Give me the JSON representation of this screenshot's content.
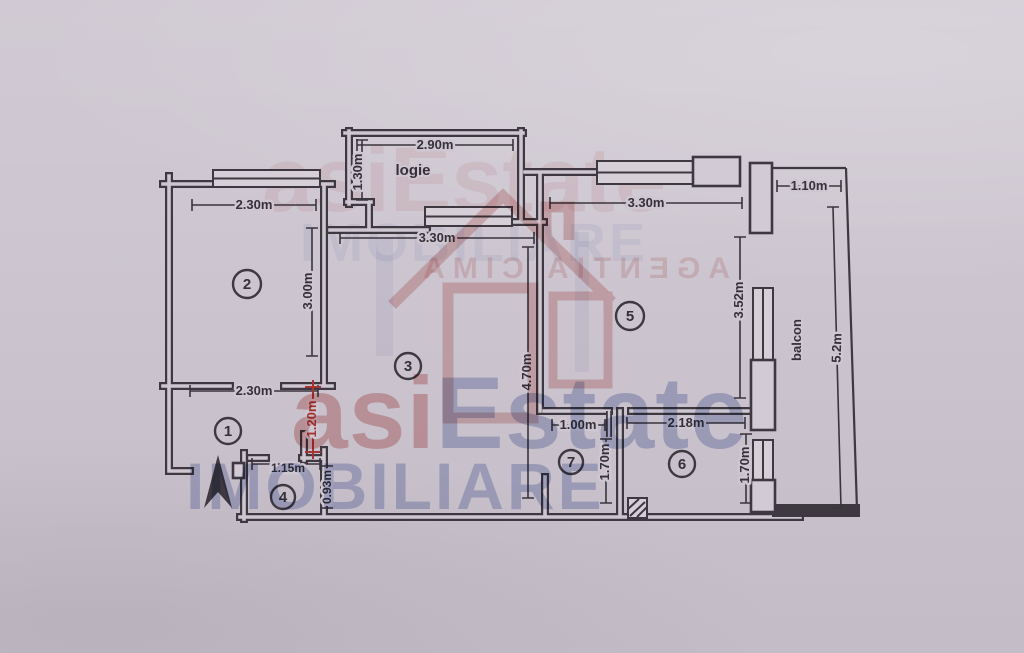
{
  "labels": {
    "loggia": "logie",
    "balcony": "balcon"
  },
  "rooms": [
    {
      "n": "1"
    },
    {
      "n": "2"
    },
    {
      "n": "3"
    },
    {
      "n": "4"
    },
    {
      "n": "5"
    },
    {
      "n": "6"
    },
    {
      "n": "7"
    }
  ],
  "dims": {
    "logie_width": "2.90m",
    "logie_depth": "1.30m",
    "room2_width": "2.30m",
    "room2_depth": "3.00m",
    "room1_width": "2.30m",
    "hall_opening": "1.20m",
    "room4_width": "1.15m",
    "room4_depth": "0.93m",
    "room3_width": "3.30m",
    "room3_depth": "4.70m",
    "room5_width": "3.30m",
    "room5_depth": "3.52m",
    "balcony_top_width": "1.10m",
    "balcony_length": "5.2m",
    "room7_width": "1.00m",
    "room7_depth": "1.70m",
    "room6_width": "2.18m",
    "room6_depth": "1.70m"
  },
  "watermark": {
    "brand_prefix": "asi",
    "brand_suffix": "Estate",
    "brand_line2": "IMOBILIARE",
    "faint_row": "asiEstate",
    "faint_row2": "IMOBILIARE",
    "stamp_line": "AGENTIA CIMA"
  },
  "colors": {
    "paper": "#cec7d1",
    "wall": "#3e3841",
    "dim_line": "#3a343d",
    "dim_red": "#a33430",
    "wm_red": "#c75f5f",
    "wm_blue": "#6f80bd"
  }
}
